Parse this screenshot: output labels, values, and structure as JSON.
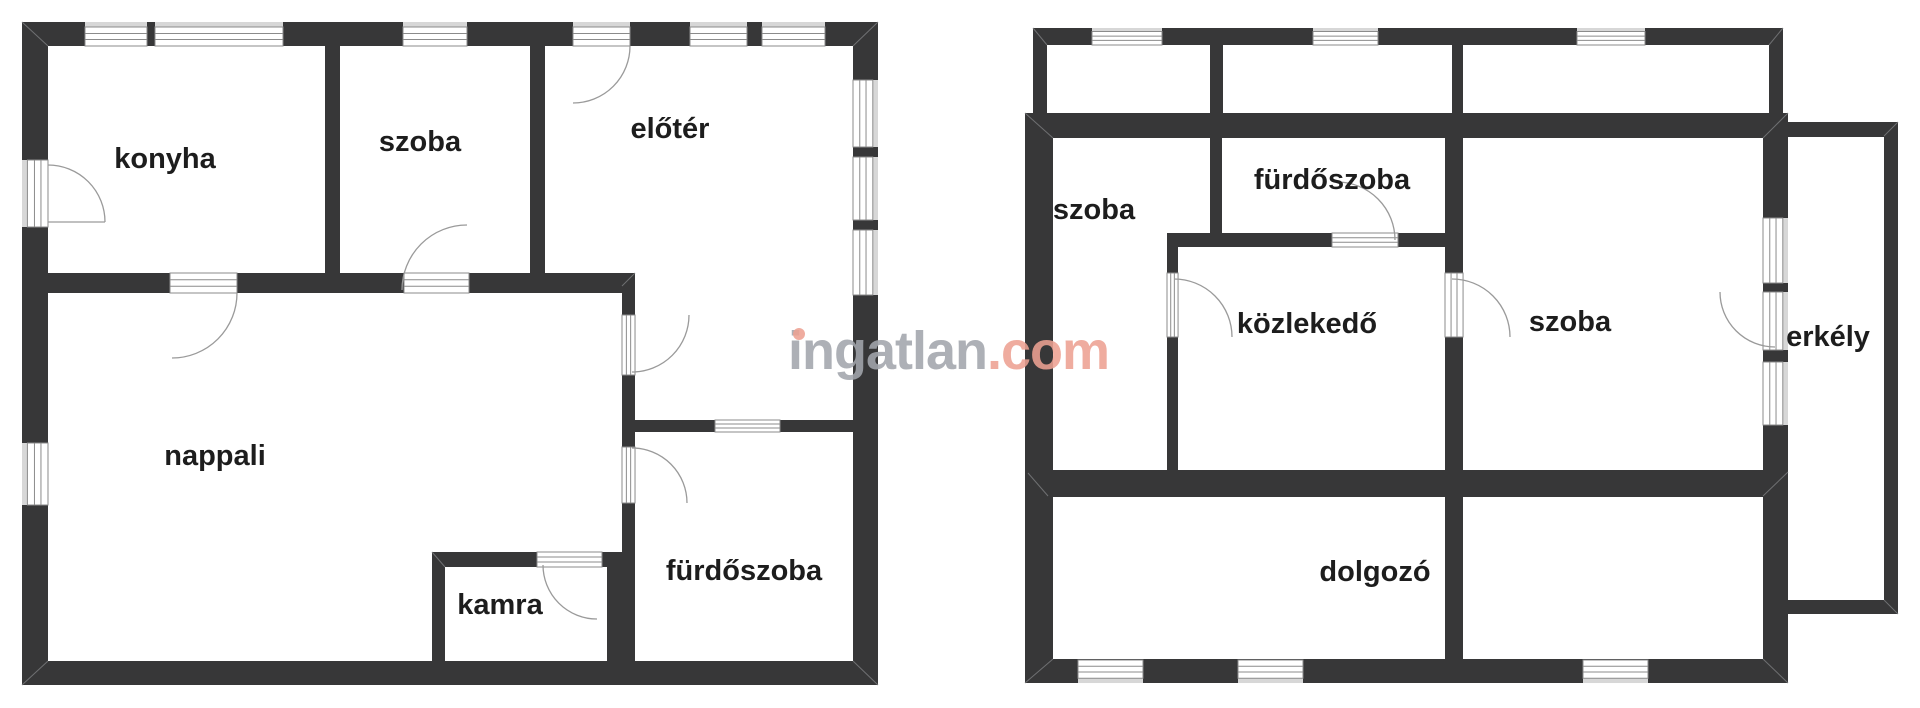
{
  "watermark": {
    "brand": "ingatlan",
    "tld": ".com"
  },
  "colors": {
    "background": "#ffffff",
    "wall": "#373738",
    "window_band": "#d7d7d7",
    "frame_stroke": "#8b8b8b",
    "arc_stroke": "#9a9a9a",
    "bevel": "#6f7072",
    "label": "#1d1d1d",
    "wm_gray": "#a2a6ad",
    "wm_salmon": "#eda192"
  },
  "plans": [
    {
      "side": "left",
      "rooms": [
        {
          "label": "konyha"
        },
        {
          "label": "szoba"
        },
        {
          "label": "előtér"
        },
        {
          "label": "nappali"
        },
        {
          "label": "kamra"
        },
        {
          "label": "fürdőszoba"
        }
      ]
    },
    {
      "side": "right",
      "rooms": [
        {
          "label": "szoba"
        },
        {
          "label": "fürdőszoba"
        },
        {
          "label": "közlekedő"
        },
        {
          "label": "szoba"
        },
        {
          "label": "erkély"
        },
        {
          "label": "dolgozó"
        }
      ]
    }
  ]
}
